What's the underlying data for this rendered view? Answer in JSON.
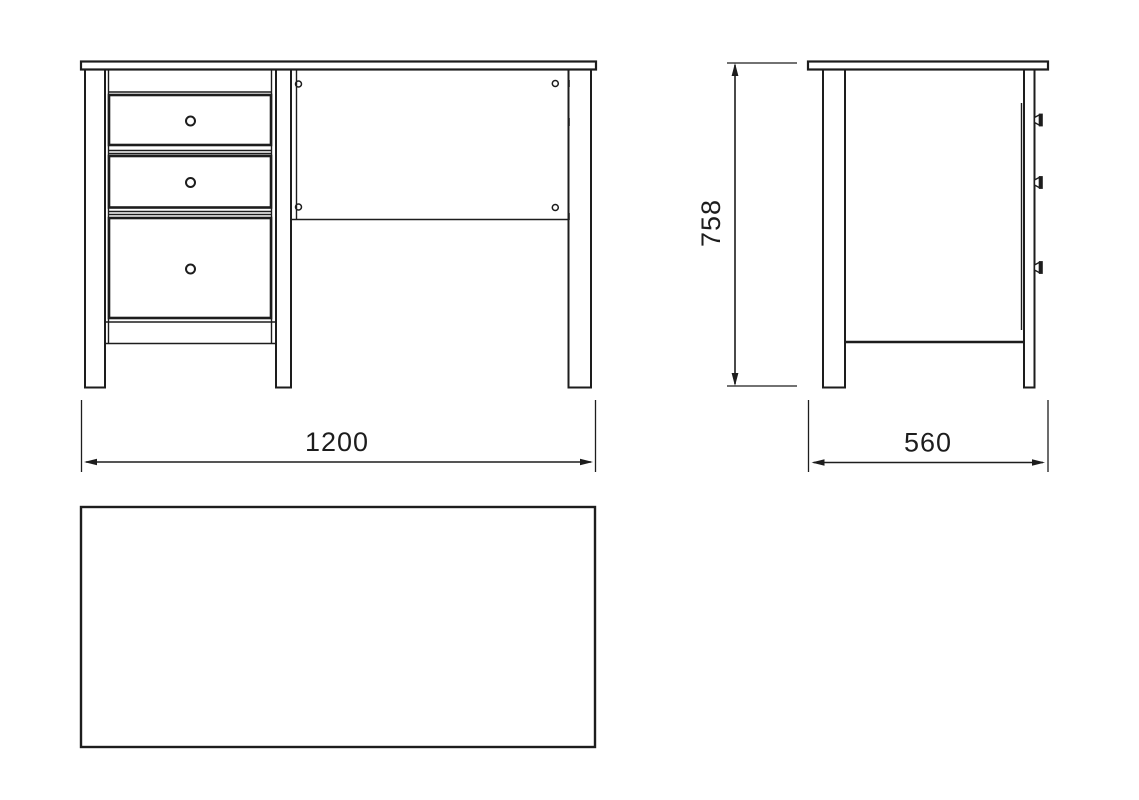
{
  "diagram": {
    "kind": "furniture-technical-drawing",
    "subject": "desk-with-three-drawers",
    "dimensions": {
      "width_label": "1200",
      "height_label": "758",
      "depth_label": "560"
    },
    "views": {
      "front": {
        "drawer_count": 3,
        "knob_count": 3,
        "screw_hole_count": 4
      },
      "side": {
        "knob_count": 3
      },
      "top": {
        "shape": "rectangle"
      }
    },
    "colors": {
      "line": "#1d1d1d",
      "background": "#ffffff"
    }
  }
}
